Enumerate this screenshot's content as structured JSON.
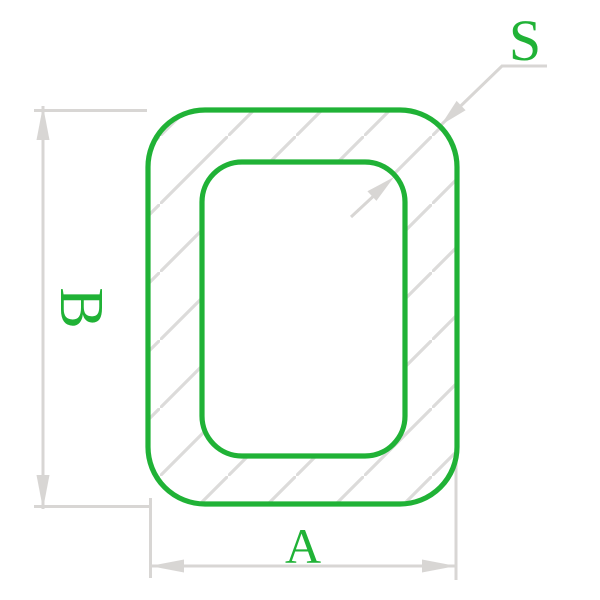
{
  "diagram": {
    "labels": {
      "width_dimension": "A",
      "height_dimension": "B",
      "wall_thickness": "S"
    },
    "colors": {
      "profile": "#20b236",
      "dimension": "#d8d6d4",
      "hatch": "#dcdbda",
      "background": "#ffffff"
    }
  }
}
